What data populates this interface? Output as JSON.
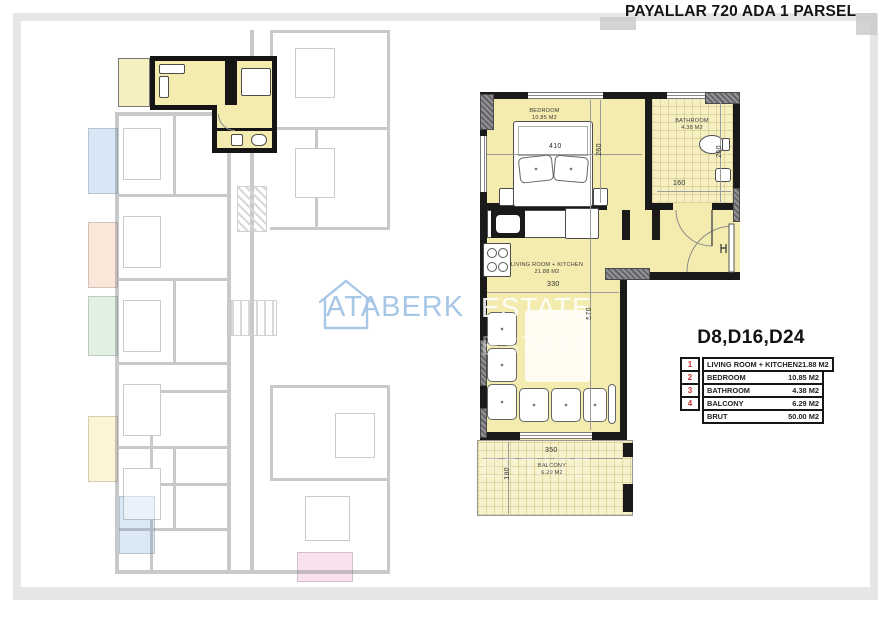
{
  "page": {
    "title": "PAYALLAR 720 ADA 1 PARSEL"
  },
  "unit": {
    "label": "D8,D16,D24"
  },
  "area_table": {
    "accent_red": "#c53030",
    "rows": [
      {
        "num": "1",
        "label": "LIVING ROOM + KITCHEN",
        "value": "21.88 M2"
      },
      {
        "num": "2",
        "label": "BEDROOM",
        "value": "10.85 M2"
      },
      {
        "num": "3",
        "label": "BATHROOM",
        "value": "4.38 M2"
      },
      {
        "num": "4",
        "label": "BALCONY",
        "value": "6.29 M2"
      },
      {
        "num": "",
        "label": "BRUT",
        "value": "50.00 M2"
      }
    ]
  },
  "detail_plan": {
    "floor_fill": "#f3ecae",
    "rooms": {
      "bedroom": {
        "name": "BEDROOM",
        "area": "10.85 M2"
      },
      "bathroom": {
        "name": "BATHROOM",
        "area": "4.38 M2"
      },
      "living": {
        "name": "LIVING ROOM + KITCHEN",
        "area": "21.88 M2"
      },
      "balcony": {
        "name": "BALCONY",
        "area": "6.29 M2"
      }
    },
    "dims": {
      "bedroom_width": "410",
      "bedroom_height": "260",
      "bathroom_height": "260",
      "bathroom_width": "160",
      "living_width": "330",
      "living_height": "570",
      "balcony_width": "350",
      "balcony_depth": "180"
    }
  },
  "watermark": {
    "brand": "ATABERK",
    "brand_secondary": "ESTATE",
    "icon": "house-outline-icon",
    "blue": "#a7c7e7"
  }
}
